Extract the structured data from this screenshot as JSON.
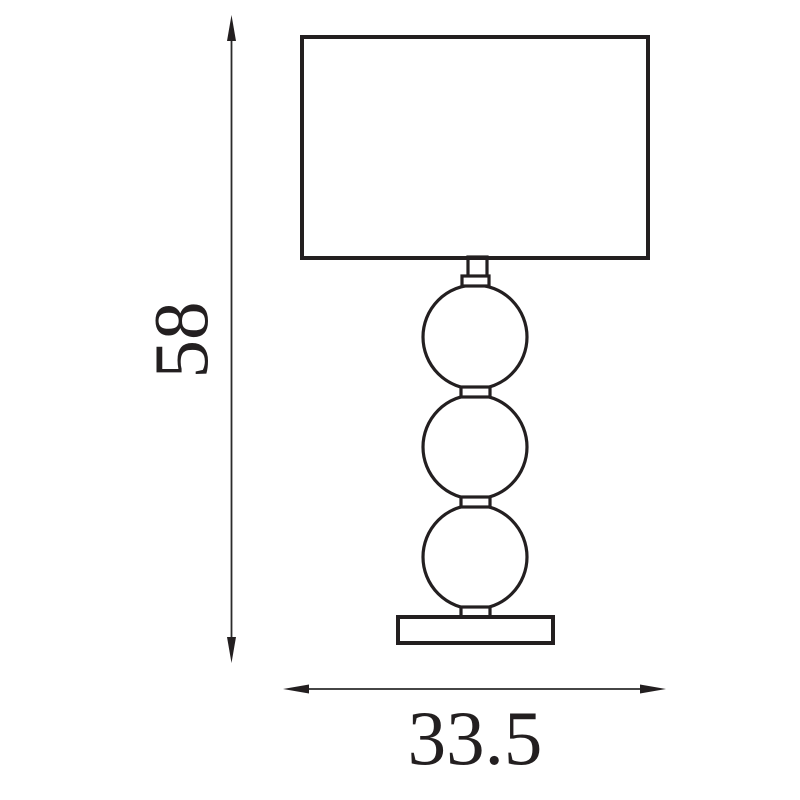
{
  "page": {
    "background_color": "#ffffff"
  },
  "diagram": {
    "kind": "technical-dimension-drawing",
    "subject": "table lamp with rectangular shade, three stacked balls and plinth base",
    "line_color": "#231f20",
    "dimensions": {
      "height": {
        "value": "58",
        "orientation": "vertical",
        "side": "left",
        "arrow_ends": "double"
      },
      "width": {
        "value": "33.5",
        "orientation": "horizontal",
        "side": "bottom",
        "arrow_ends": "double"
      }
    }
  }
}
